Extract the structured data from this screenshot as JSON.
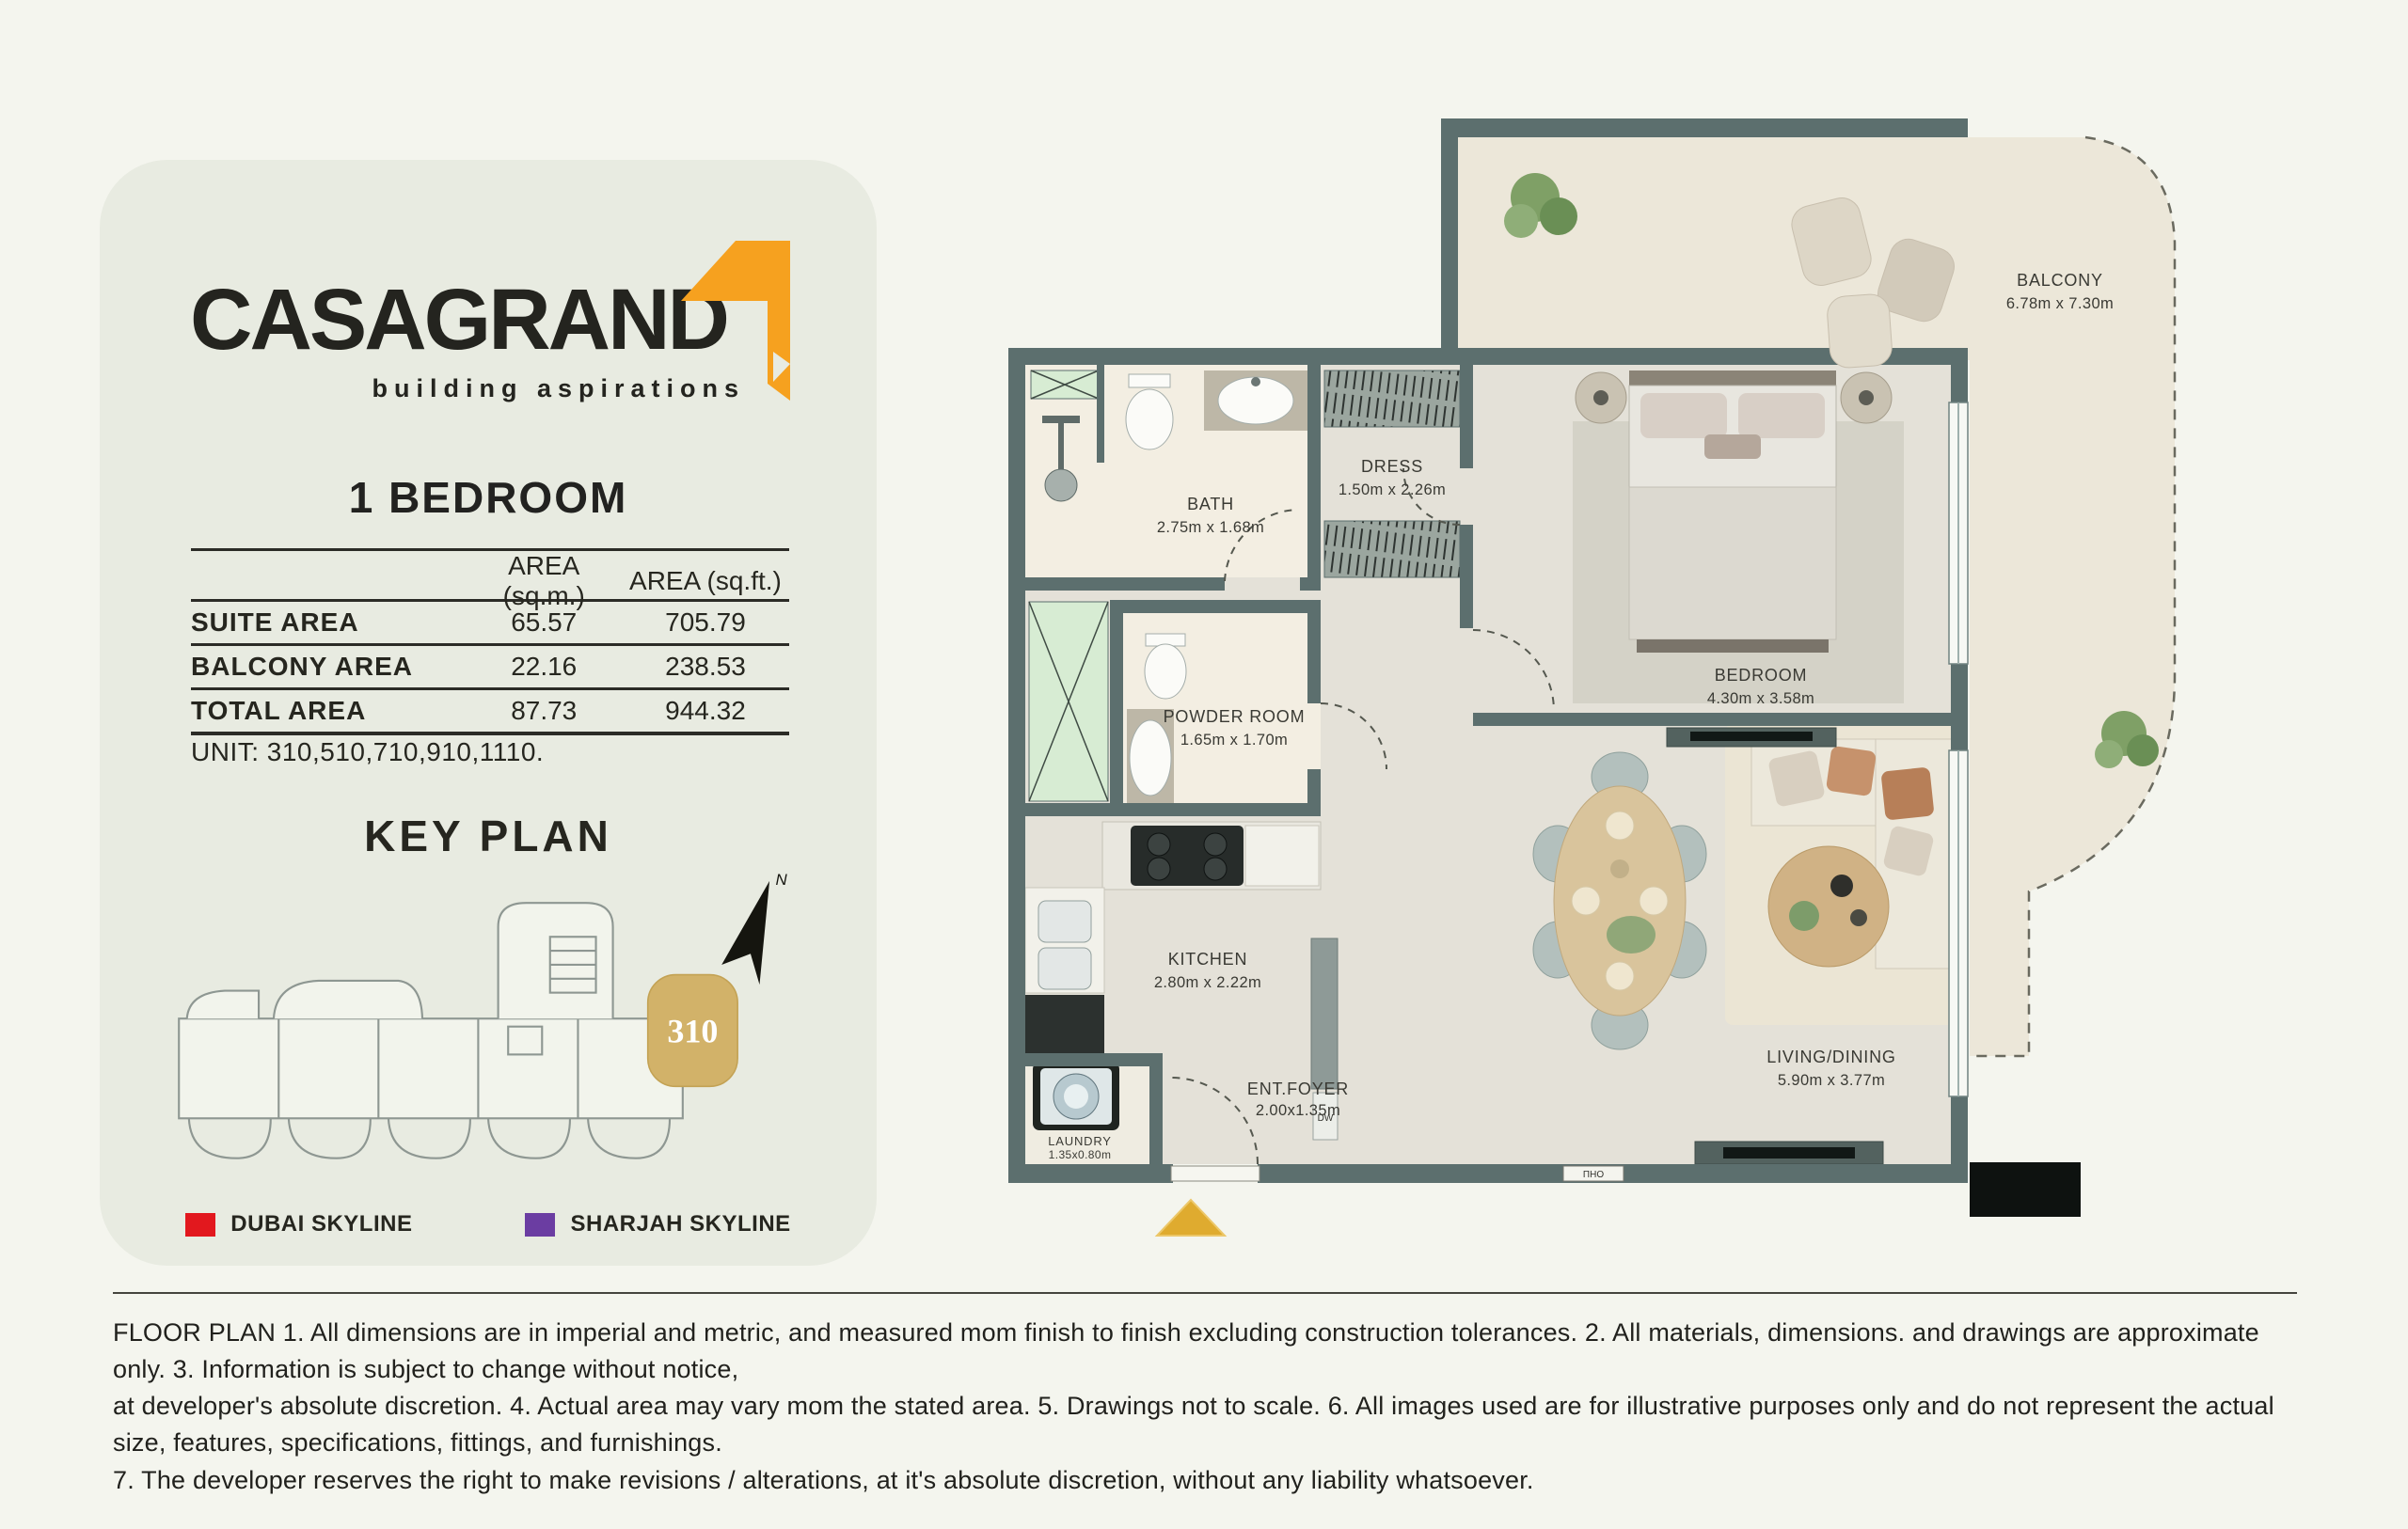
{
  "brand": {
    "name": "CASAGRAND",
    "tagline": "building aspirations"
  },
  "unit_card": {
    "title": "1 BEDROOM",
    "table": {
      "col_headers": {
        "sqm": "AREA (sq.m.)",
        "sqft": "AREA (sq.ft.)"
      },
      "rows": [
        {
          "label": "SUITE  AREA",
          "sqm": "65.57",
          "sqft": "705.79"
        },
        {
          "label": "BALCONY  AREA",
          "sqm": "22.16",
          "sqft": "238.53"
        },
        {
          "label": "TOTAL  AREA",
          "sqm": "87.73",
          "sqft": "944.32"
        }
      ]
    },
    "unit_line": "UNIT: 310,510,710,910,1110.",
    "key_plan_title": "KEY PLAN",
    "highlighted_unit": "310",
    "north_label": "N",
    "legend": [
      {
        "label": "DUBAI SKYLINE",
        "color": "#e2181e"
      },
      {
        "label": "SHARJAH SKYLINE",
        "color": "#6b3da2"
      }
    ]
  },
  "floorplan": {
    "rooms": [
      {
        "name": "BALCONY",
        "dims": "6.78m x 7.30m"
      },
      {
        "name": "BATH",
        "dims": "2.75m x 1.68m"
      },
      {
        "name": "DRESS",
        "dims": "1.50m x 2.26m"
      },
      {
        "name": "BEDROOM",
        "dims": "4.30m x 3.58m"
      },
      {
        "name": "POWDER ROOM",
        "dims": "1.65m x 1.70m"
      },
      {
        "name": "KITCHEN",
        "dims": "2.80m x 2.22m"
      },
      {
        "name": "ENT.FOYER",
        "dims": "2.00x1.35m"
      },
      {
        "name": "LAUNDRY",
        "dims": "1.35x0.80m"
      },
      {
        "name": "LIVING/DINING",
        "dims": "5.90m x 3.77m"
      }
    ],
    "tags": {
      "dishwasher": "DW",
      "entry_plate": "ПНО"
    }
  },
  "disclaimer": {
    "lines": [
      "FLOOR PLAN 1. All dimensions are in imperial and metric, and measured mom finish to finish excluding construction tolerances. 2. All materials, dimensions. and drawings are approximate only. 3. Information is subject to change without notice,",
      "at developer's absolute discretion. 4. Actual area may vary mom the stated area. 5. Drawings not to scale. 6. All images used are for illustrative purposes only and do not represent the actual size, features, specifications, fittings, and furnishings.",
      "7. The developer reserves the right to make revisions / alterations, at it's absolute discretion, without any liability whatsoever."
    ]
  },
  "colors": {
    "page_bg": "#f4f5ee",
    "card_bg": "#e8ebe1",
    "wall": "#5c6f6e",
    "floor_main": "#e4e1d8",
    "floor_cream": "#f3eee2",
    "floor_balcony": "#ece7d9",
    "shaft_green": "#d7ecd3",
    "brand_orange": "#f6a11f",
    "unit_gold": "#d2b269",
    "entry_triangle_gold": "#dfab2f",
    "legend_red": "#e2181e",
    "legend_purple": "#6b3da2"
  }
}
